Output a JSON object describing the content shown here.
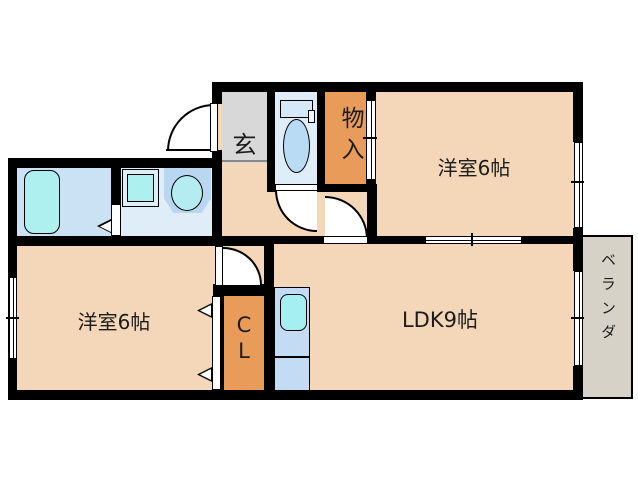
{
  "plan": {
    "type": "apartment-floor-plan",
    "rooms": {
      "genkan": {
        "label": "玄"
      },
      "storage": {
        "label": "物入"
      },
      "bedroom_top": {
        "label": "洋室6帖"
      },
      "bedroom_bottom": {
        "label": "洋室6帖"
      },
      "ldk": {
        "label": "LDK9帖"
      },
      "closet": {
        "label": "CL",
        "line1": "C",
        "line2": "L"
      },
      "veranda": {
        "label": "ベランダ"
      }
    },
    "fixtures": [
      "bathtub",
      "washing-machine",
      "wash-basin",
      "toilet",
      "kitchen-sink"
    ],
    "colors": {
      "floor_peach": "#f4d6b9",
      "closet_orange": "#e99b59",
      "genkan_gray": "#d8d8d8",
      "veranda_gray": "#d6d2c8",
      "wet_floor": "#dfedf9",
      "bath_floor": "#cbe1f4",
      "fixture_cyan": "#aeeff0",
      "kitchen_blue": "#c3dcf4",
      "wall": "#000000"
    }
  }
}
